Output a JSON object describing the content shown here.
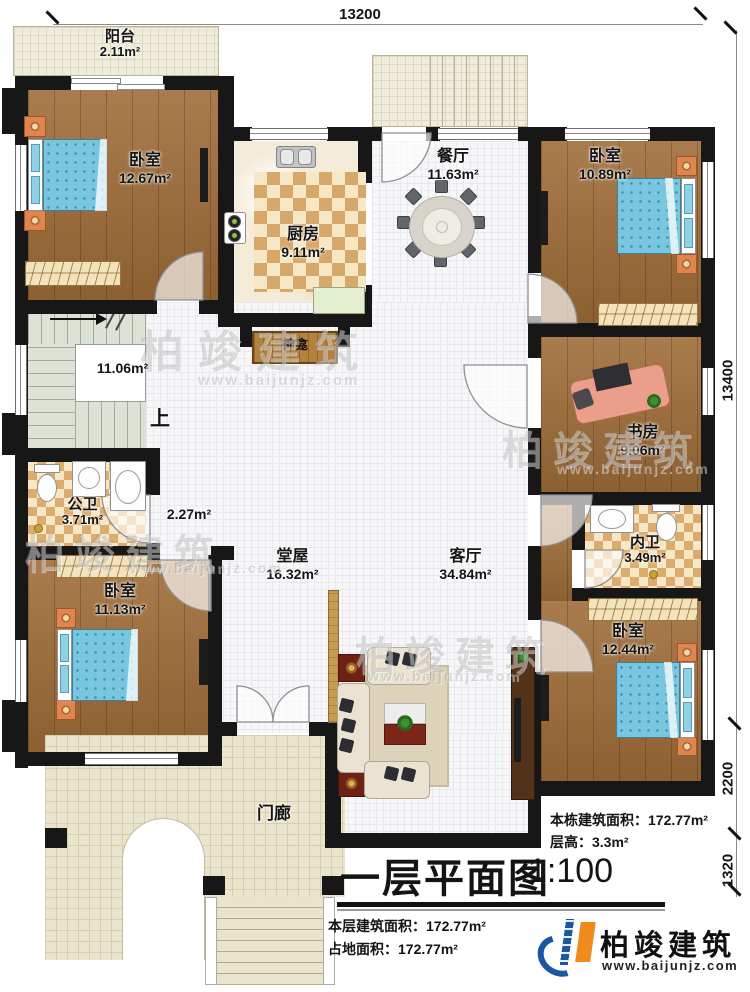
{
  "dimensions": {
    "top": "13200",
    "right_total": "13400",
    "right_mid": "2200",
    "right_bottom": "1320"
  },
  "rooms": {
    "balcony": {
      "name": "阳台",
      "area": "2.11m²"
    },
    "bedroom_tl": {
      "name": "卧室",
      "area": "12.67m²"
    },
    "kitchen": {
      "name": "厨房",
      "area": "9.11m²"
    },
    "dining": {
      "name": "餐厅",
      "area": "11.63m²"
    },
    "bedroom_tr": {
      "name": "卧室",
      "area": "10.89m²"
    },
    "stairs": {
      "area": "11.06m²",
      "up": "上"
    },
    "shrine": {
      "name": "神龛"
    },
    "public_bath": {
      "name": "公卫",
      "area": "3.71m²"
    },
    "corridor": {
      "area": "2.27m²"
    },
    "hall": {
      "name": "堂屋",
      "area": "16.32m²"
    },
    "living": {
      "name": "客厅",
      "area": "34.84m²"
    },
    "study": {
      "name": "书房",
      "area": "9.06m²"
    },
    "ensuite_bath": {
      "name": "内卫",
      "area": "3.49m²"
    },
    "bedroom_bl": {
      "name": "卧室",
      "area": "11.13m²"
    },
    "bedroom_br": {
      "name": "卧室",
      "area": "12.44m²"
    },
    "porch": {
      "name": "门廊"
    }
  },
  "notes": {
    "building_area_label": "本栋建筑面积：",
    "building_area_value": "172.77m²",
    "floor_height_label": "层高：",
    "floor_height_value": "3.3m²"
  },
  "title": {
    "text": "一层平面图",
    "scale": "1:100"
  },
  "footer": {
    "floor_area_label": "本层建筑面积：",
    "floor_area_value": "172.77m²",
    "land_area_label": "占地面积：",
    "land_area_value": "172.77m²"
  },
  "brand": {
    "name": "柏竣建筑",
    "url": "www.baijunjz.com"
  },
  "watermark": {
    "name": "柏竣建筑",
    "url": "www.baijunjz.com"
  },
  "colors": {
    "brand_blue": "#1a57a0",
    "brand_orange": "#ef8b1c",
    "bed_blue": "#79c6e0"
  }
}
